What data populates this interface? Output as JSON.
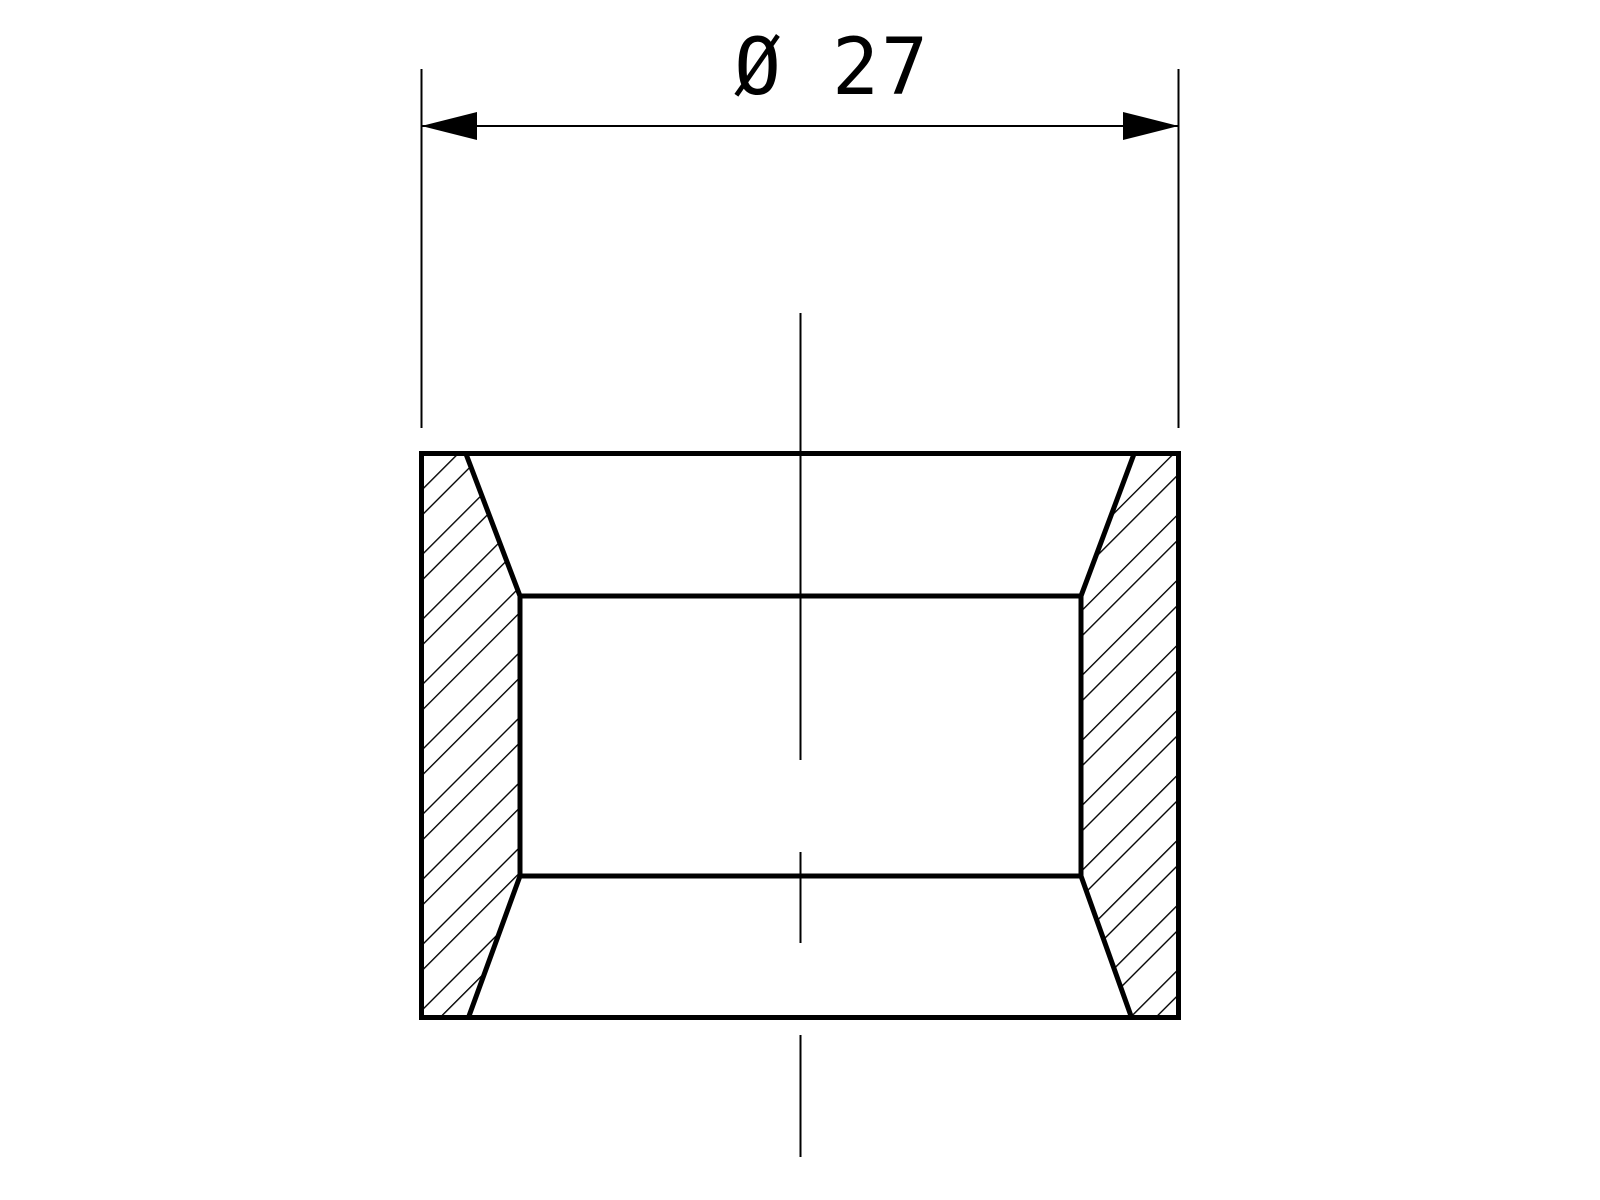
{
  "drawing": {
    "colors": {
      "background": "#ffffff",
      "line": "#000000"
    },
    "dimension": {
      "label": "Ø 27",
      "symbol": "Ø",
      "value": "27"
    }
  }
}
